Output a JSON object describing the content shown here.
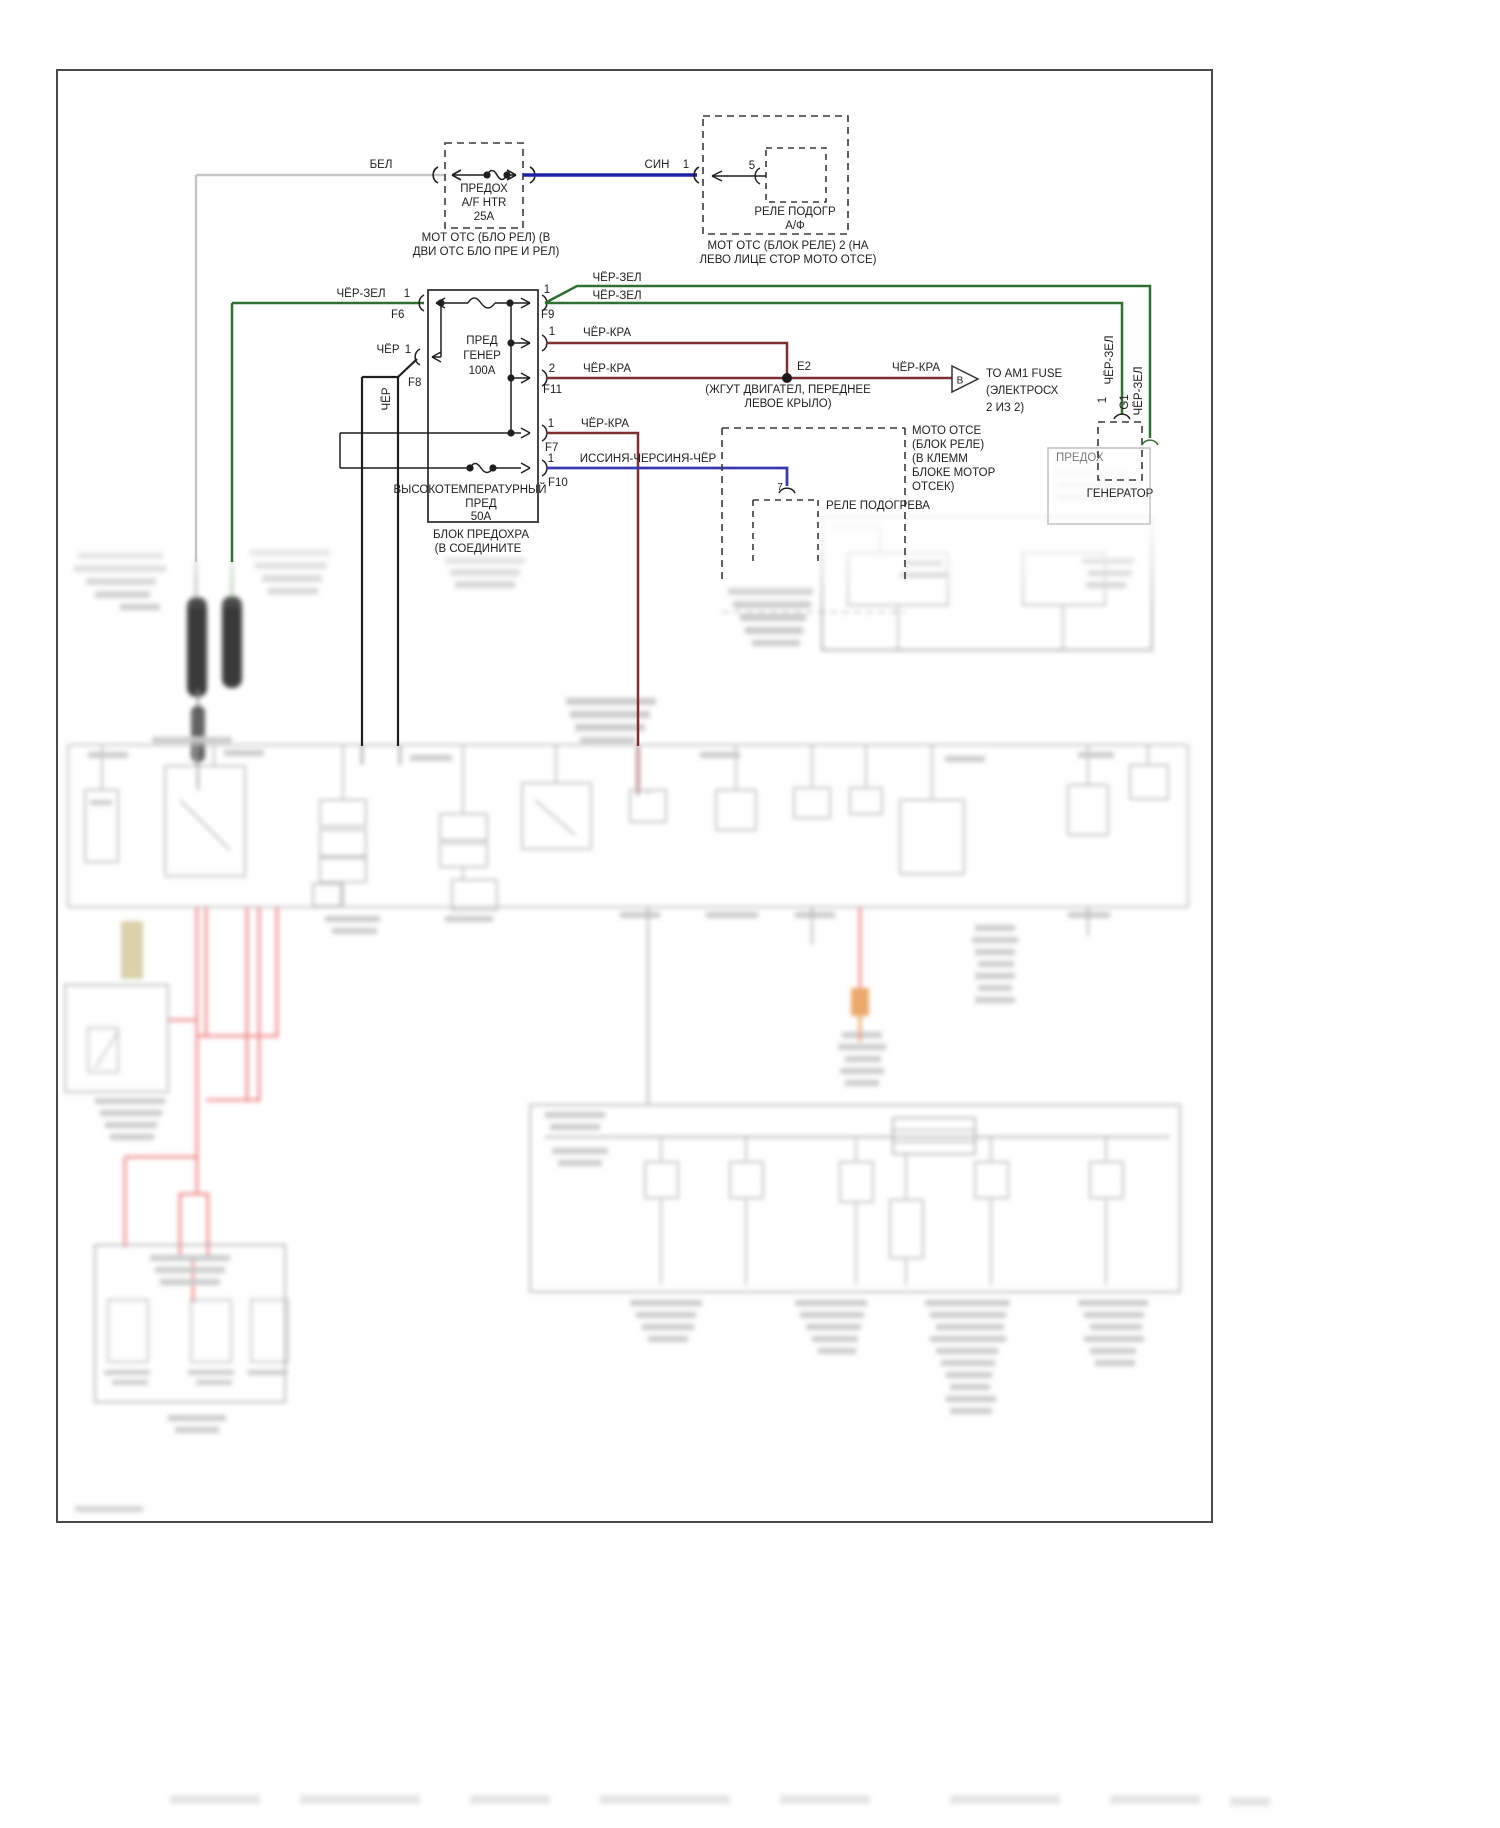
{
  "labels": {
    "bel": "БЕЛ",
    "sin": "СИН",
    "cher_zel": "ЧЁР-ЗЕЛ",
    "cher": "ЧЁР",
    "cher_kra": "ЧЁР-КРА",
    "issinya_cher": "ИССИНЯ-ЧЕРСИНЯ-ЧЁР",
    "pin1": "1",
    "pin2": "2",
    "pin5": "5",
    "pin7": "7",
    "f6": "F6",
    "f7": "F7",
    "f8": "F8",
    "f9": "F9",
    "f10": "F10",
    "f11": "F11",
    "e2": "E2",
    "g1": "G1",
    "b": "B"
  },
  "fuse_af": {
    "l1": "ПРЕДОХ",
    "l2": "A/F HTR",
    "l3": "25A",
    "loc1": "МОТ ОТС (БЛО РЕЛ) (В",
    "loc2": "ДВИ ОТС БЛО ПРЕ И РЕЛ)"
  },
  "relay_af": {
    "l1": "РЕЛЕ ПОДОГР",
    "l2": "А/Ф",
    "loc1": "МОТ ОТС (БЛОК РЕЛЕ) 2 (НА",
    "loc2": "ЛЕВО ЛИЦЕ СТОР МОТО ОТСЕ)"
  },
  "fuse_block": {
    "gen1": "ПРЕД",
    "gen2": "ГЕНЕР",
    "gen3": "100А",
    "ht1": "ВЫСОКОТЕМПЕРАТУРНЫЙ",
    "ht2": "ПРЕД",
    "ht3": "50А",
    "loc1": "БЛОК ПРЕДОХРА",
    "loc2": "(В СОЕДИНИТЕ"
  },
  "e2_loc": {
    "l1": "(ЖГУТ ДВИГАТЕЛ, ПЕРЕДНЕЕ",
    "l2": "ЛЕВОЕ КРЫЛО)"
  },
  "am1": {
    "l1": "ТО AM1 FUSE",
    "l2": "(ЭЛЕКТРОСХ",
    "l3": "2 ИЗ 2)"
  },
  "moto_box": {
    "l1": "МОТО ОТСЕ",
    "l2": "(БЛОК РЕЛЕ)",
    "l3": "(В КЛЕММ",
    "l4": "БЛОКЕ МОТОР",
    "l5": "ОТСЕК)"
  },
  "rele_podogreva": "РЕЛЕ ПОДОГРЕВА",
  "generator": "ГЕНЕРАТОР",
  "predoh": "ПРЕДОХ",
  "colors": {
    "wire_white": "#c6c6c6",
    "wire_blue": "#2020a6",
    "wire_green": "#2f7030",
    "wire_black": "#1f1f1f",
    "wire_darkred": "#7e3030",
    "wire_lightblue": "#3b3bb0",
    "blur_red": "#ee8585",
    "blur_orange": "#e8a25e"
  }
}
